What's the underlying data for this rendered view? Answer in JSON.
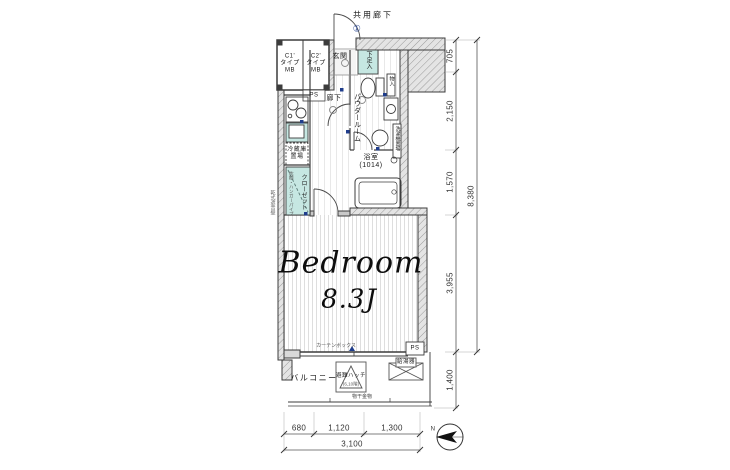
{
  "labels": {
    "corridor": "共用廊下",
    "door_no": "①",
    "entrance": "玄関",
    "shoe": "下足入",
    "mb1": "C1'\nタイプ\nMB",
    "mb2": "C2'\nタイプ\nMB",
    "ps_top": "PS",
    "hallway": "廊下",
    "powder": "パウダールーム",
    "storage": "物入",
    "washer": "洗濯機置場",
    "fridge": "冷蔵庫\n置場",
    "closet": "クローゼット",
    "closet_note": "枕棚・ハンガーパイプ",
    "bath": "浴室\n(1014)",
    "bedroom": "Bedroom",
    "size": "8.3J",
    "curtain": "カーテンボックス",
    "ps_bottom": "PS",
    "balcony": "バルコニー",
    "hatch": "避難ハッチ",
    "hatch_note": "(6,10階)",
    "heater": "給湯器",
    "laundry": "物干金物",
    "wall_note": "乾式遮音壁",
    "north": "N"
  },
  "dims": {
    "right": [
      "705",
      "2,150",
      "1,570",
      "3,955",
      "1,400"
    ],
    "right_total": "8,380",
    "bottom": [
      "680",
      "1,120",
      "1,300"
    ],
    "bottom_total": "3,100"
  },
  "colors": {
    "wall": "#3c3c3c",
    "storage_teal": "#c6e7e2",
    "symbol_blue": "#1f3d8c",
    "floor_line": "#d6d6d6"
  }
}
